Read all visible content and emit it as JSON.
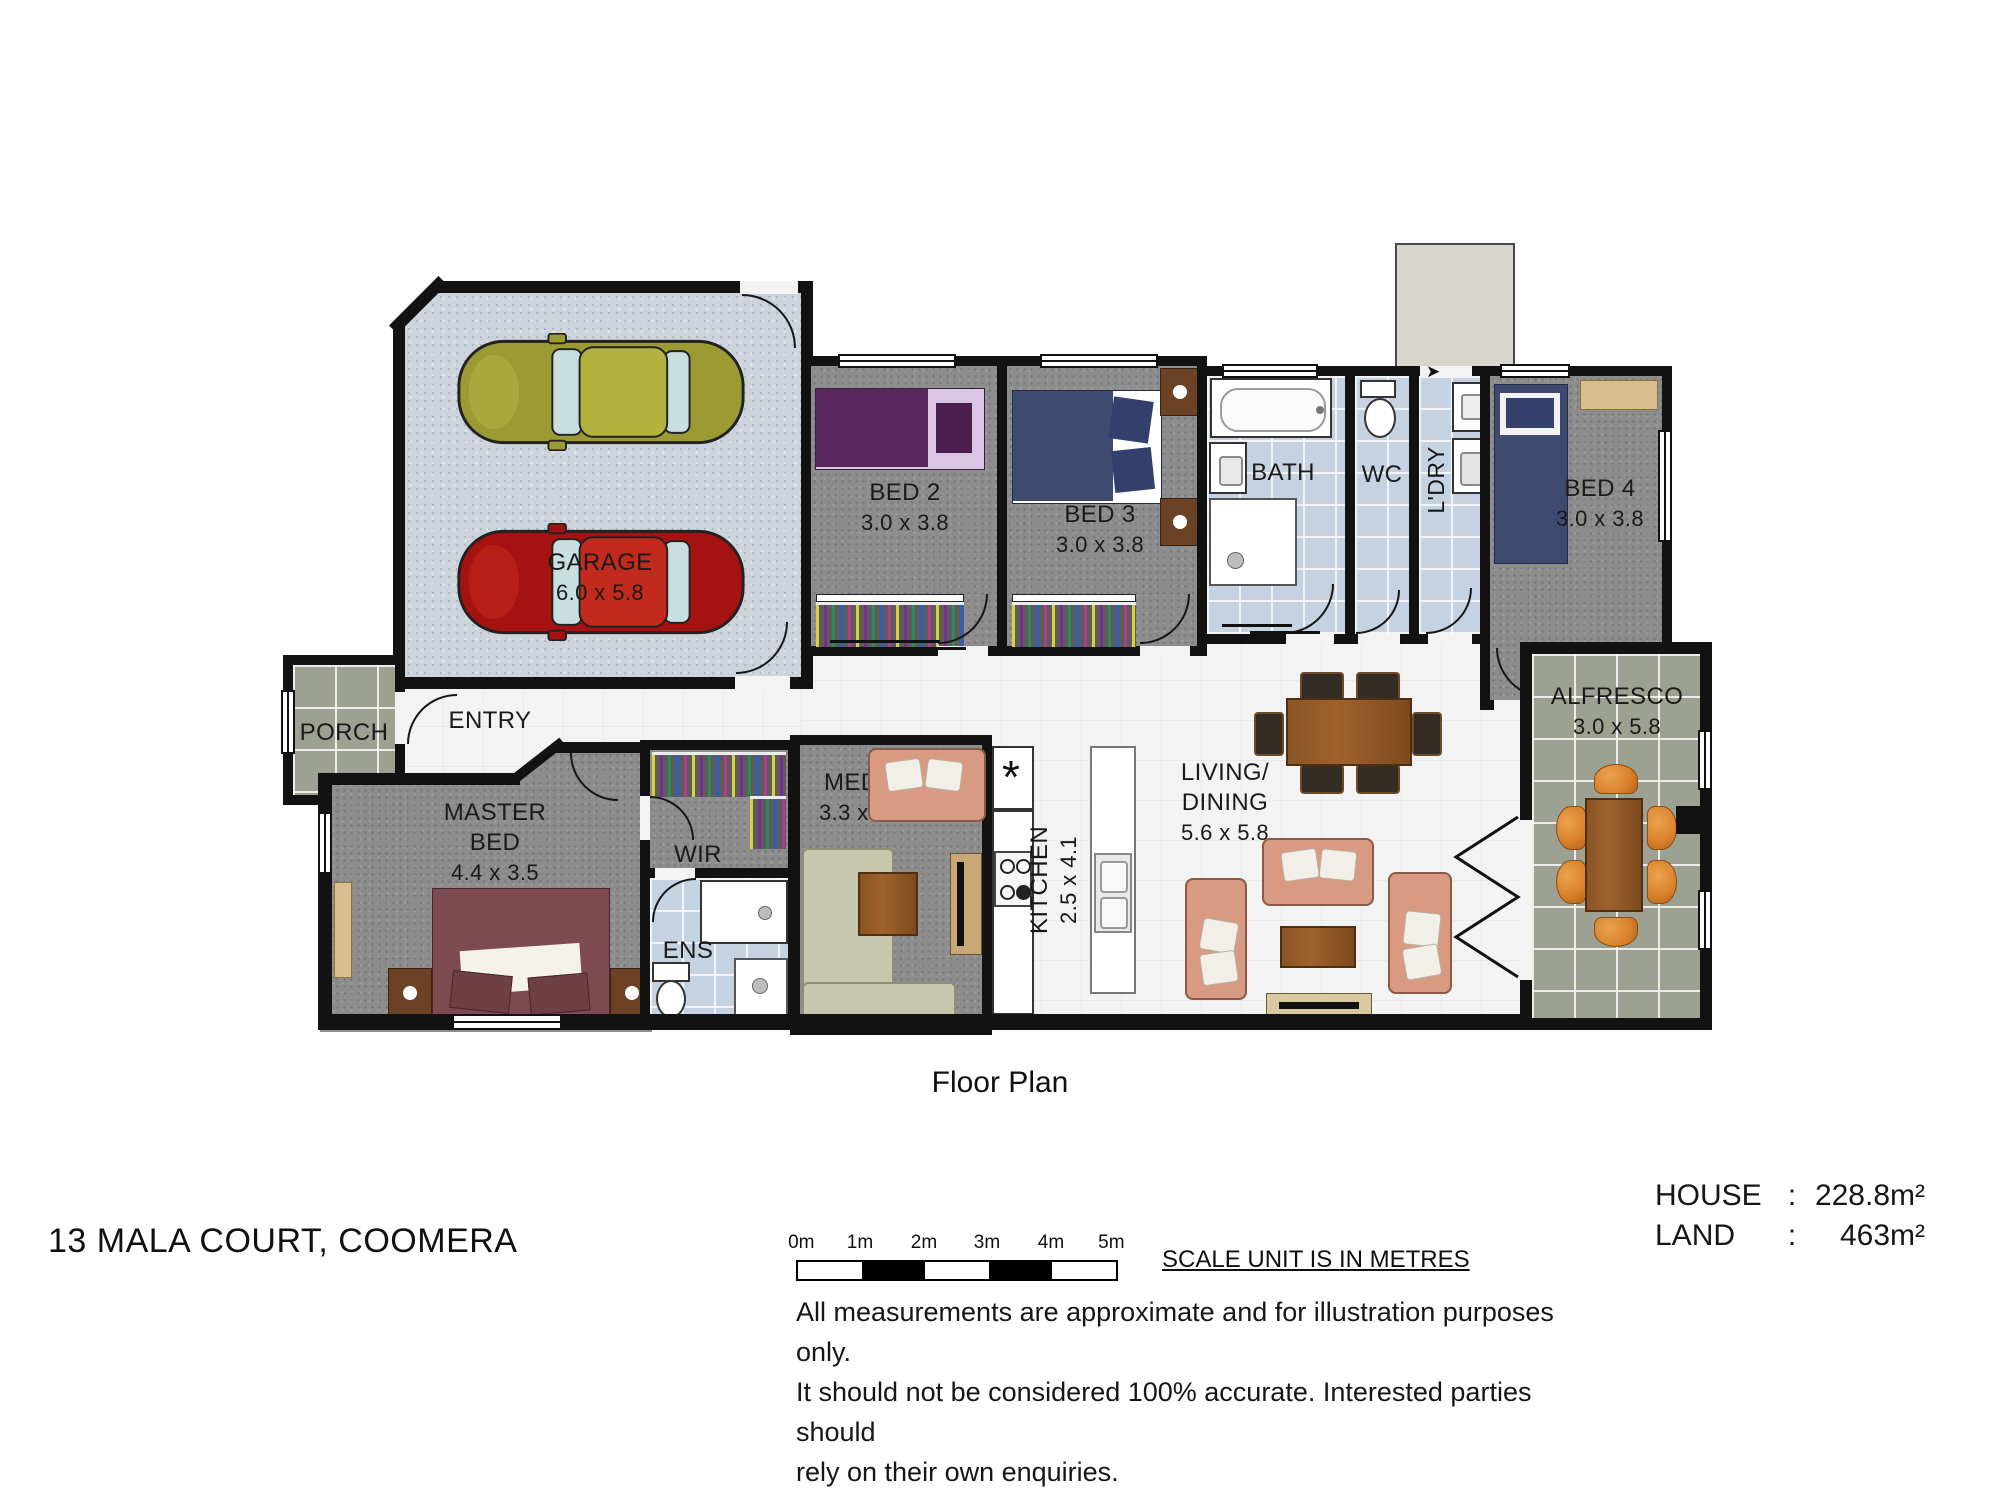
{
  "title": {
    "floor_plan": "Floor Plan",
    "address": "13 MALA COURT, COOMERA"
  },
  "rooms": {
    "garage": {
      "name": "GARAGE",
      "dims": "6.0 x 5.8"
    },
    "bed2": {
      "name": "BED 2",
      "dims": "3.0 x 3.8"
    },
    "bed3": {
      "name": "BED 3",
      "dims": "3.0 x 3.8"
    },
    "bed4": {
      "name": "BED 4",
      "dims": "3.0 x 3.8"
    },
    "bath": {
      "name": "BATH"
    },
    "wc": {
      "name": "WC"
    },
    "ldry": {
      "name": "L'DRY"
    },
    "porch": {
      "name": "PORCH"
    },
    "entry": {
      "name": "ENTRY"
    },
    "master": {
      "line1": "MASTER",
      "line2": "BED",
      "dims": "4.4 x 3.5"
    },
    "wir": {
      "name": "WIR"
    },
    "ens": {
      "name": "ENS"
    },
    "media": {
      "name": "MEDIA",
      "dims": "3.3 x 4.0"
    },
    "kitchen": {
      "name": "KITCHEN",
      "dims": "2.5 x 4.1",
      "pantry_symbol": "*"
    },
    "living": {
      "line1": "LIVING/",
      "line2": "DINING",
      "dims": "5.6 x 5.8"
    },
    "alfresco": {
      "name": "ALFRESCO",
      "dims": "3.0 x 5.8"
    }
  },
  "scale": {
    "ticks": [
      "0m",
      "1m",
      "2m",
      "3m",
      "4m",
      "5m"
    ],
    "note": "SCALE UNIT IS IN METRES"
  },
  "disclaimer": {
    "lines": [
      "All measurements are approximate and for illustration purposes only.",
      "It should not be considered 100% accurate. Interested parties should",
      "rely on their own enquiries."
    ]
  },
  "areas": {
    "house_label": "HOUSE",
    "house_sep": ":",
    "house_value": "228.8m²",
    "land_label": "LAND",
    "land_sep": ":",
    "land_value": "463m²"
  },
  "colors": {
    "wall": "#121212",
    "carpet": "#8d8d8d",
    "concrete": "#ccd3da",
    "wet_tile": "#c4d2e1",
    "outdoor_tile": "#9ca192",
    "hall_floor": "#f3f3f3",
    "car_olive": "#9c9a33",
    "car_red": "#a51212",
    "sofa_salmon": "#d89a81",
    "bed_purple": "#58265c",
    "bed_navy": "#3e4a70",
    "bed_maroon": "#7c4a50",
    "chair_orange": "#d9822b",
    "timber": "#8a5424"
  }
}
